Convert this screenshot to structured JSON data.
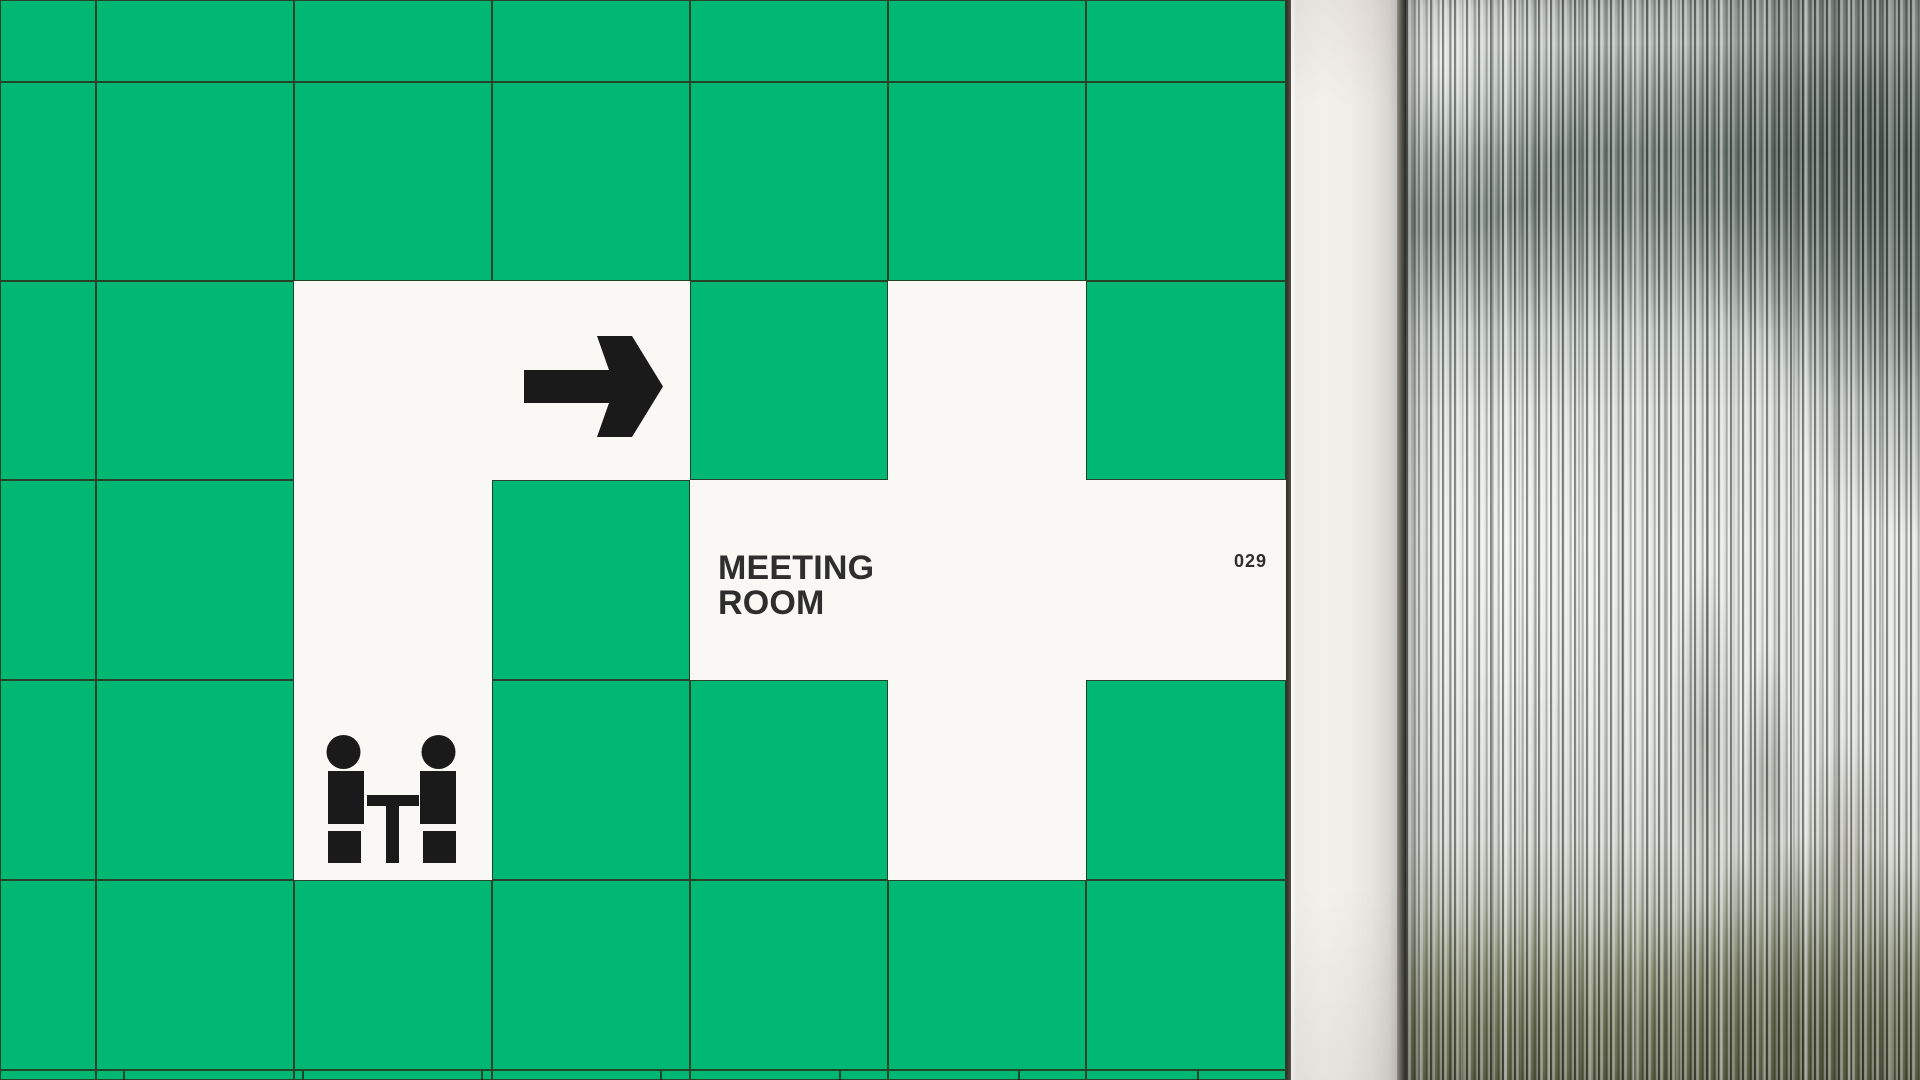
{
  "sign": {
    "room_label": "MEETING\nROOM",
    "room_number": "029",
    "arrow_icon": "arrow-right",
    "people_icon": "two-people-seated-at-table"
  },
  "colors": {
    "tile_green": "#00b873",
    "tile_white": "#f9f8f4",
    "grout": "#2d2a16",
    "ink": "#1a1a1a",
    "ink_text": "#2e2e2e",
    "glass_dark": "#3f4a42",
    "glass_light": "#e7eae6",
    "glass_olive": "#585a40",
    "wall_strip": "#f1ede9"
  },
  "mosaic": {
    "rows": 7,
    "columns": 7,
    "white_cells": [
      [
        2,
        2
      ],
      [
        2,
        3
      ],
      [
        2,
        5
      ],
      [
        3,
        2
      ],
      [
        3,
        4
      ],
      [
        3,
        5
      ],
      [
        3,
        6
      ],
      [
        4,
        2
      ],
      [
        4,
        5
      ]
    ]
  }
}
